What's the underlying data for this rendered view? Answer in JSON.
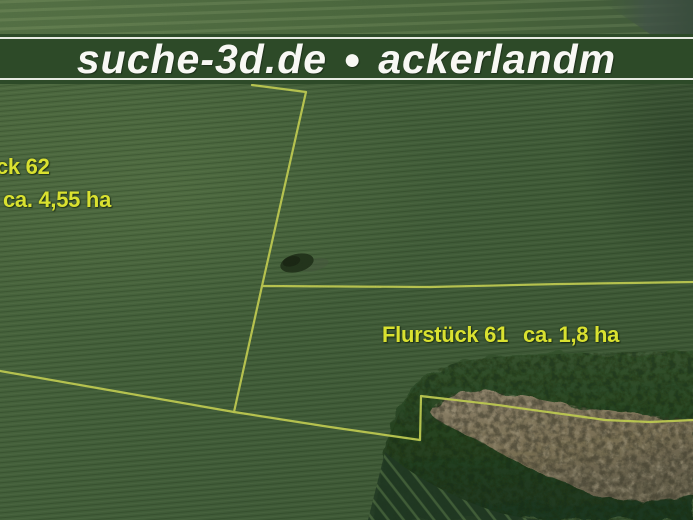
{
  "banner": {
    "text_left": "suche-3d.de",
    "separator": "●",
    "text_right": "ackerlandm"
  },
  "parcels": [
    {
      "name": "ck 62",
      "area": "ca. 4,55 ha"
    },
    {
      "name": "Flurstück 61",
      "area": "ca. 1,8 ha"
    }
  ],
  "colors": {
    "banner-green": "#2d4a28",
    "banner-text": "#f8f8f4",
    "boundary-yellow": "#d3dd55",
    "label-yellow": "#d9e130",
    "field-green": "#44613a",
    "forest-green": "#2c4527",
    "canopy-brown": "#8d7d67"
  }
}
